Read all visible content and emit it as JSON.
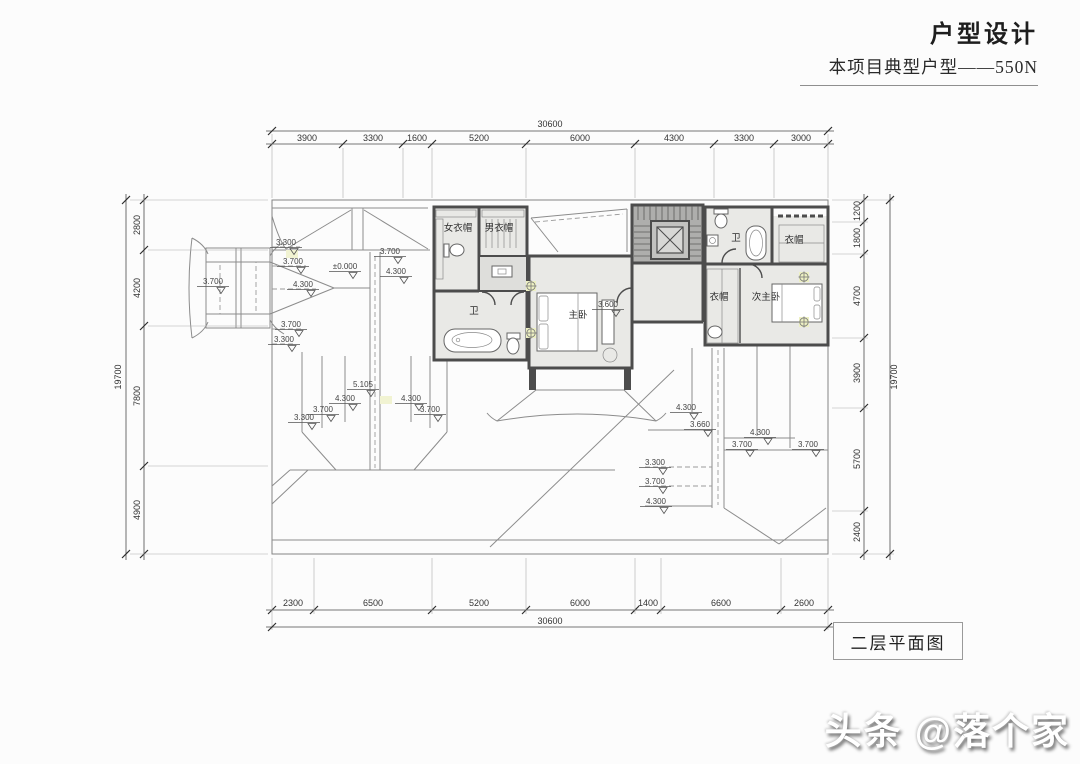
{
  "header": {
    "title": "户型设计",
    "subtitle": "本项目典型户型——550N"
  },
  "drawing": {
    "caption": "二层平面图",
    "watermark": "头条 @落个家"
  },
  "dims": {
    "top": {
      "overall": "30600",
      "segs": [
        "3900",
        "3300",
        "1600",
        "5200",
        "6000",
        "4300",
        "3300",
        "3000"
      ]
    },
    "bottom": {
      "overall": "30600",
      "segs": [
        "2300",
        "6500",
        "5200",
        "6000",
        "1400",
        "6600",
        "2600"
      ]
    },
    "left": {
      "overall": "19700",
      "segs": [
        "2800",
        "4200",
        "7800",
        "4900"
      ]
    },
    "right": {
      "overall": "19700",
      "segs": [
        "1200",
        "1800",
        "4700",
        "3900",
        "5700",
        "2400"
      ]
    }
  },
  "rooms": {
    "closet_women": "女衣帽",
    "closet_men": "男衣帽",
    "bath_master": "卫",
    "master_bedroom": "主卧",
    "bath_second": "卫",
    "closet_top_right": "衣帽",
    "closet_second": "衣帽",
    "second_master_bedroom": "次主卧"
  },
  "levels": [
    "3.300",
    "3.700",
    "3.700",
    "±0.000",
    "4.300",
    "4.300",
    "3.700",
    "3.700",
    "3.300",
    "3.300",
    "3.700",
    "4.300",
    "5.105",
    "4.300",
    "3.700",
    "3.600",
    "4.300",
    "3.660",
    "4.300",
    "3.700",
    "3.700",
    "3.300",
    "3.700",
    "4.300"
  ]
}
